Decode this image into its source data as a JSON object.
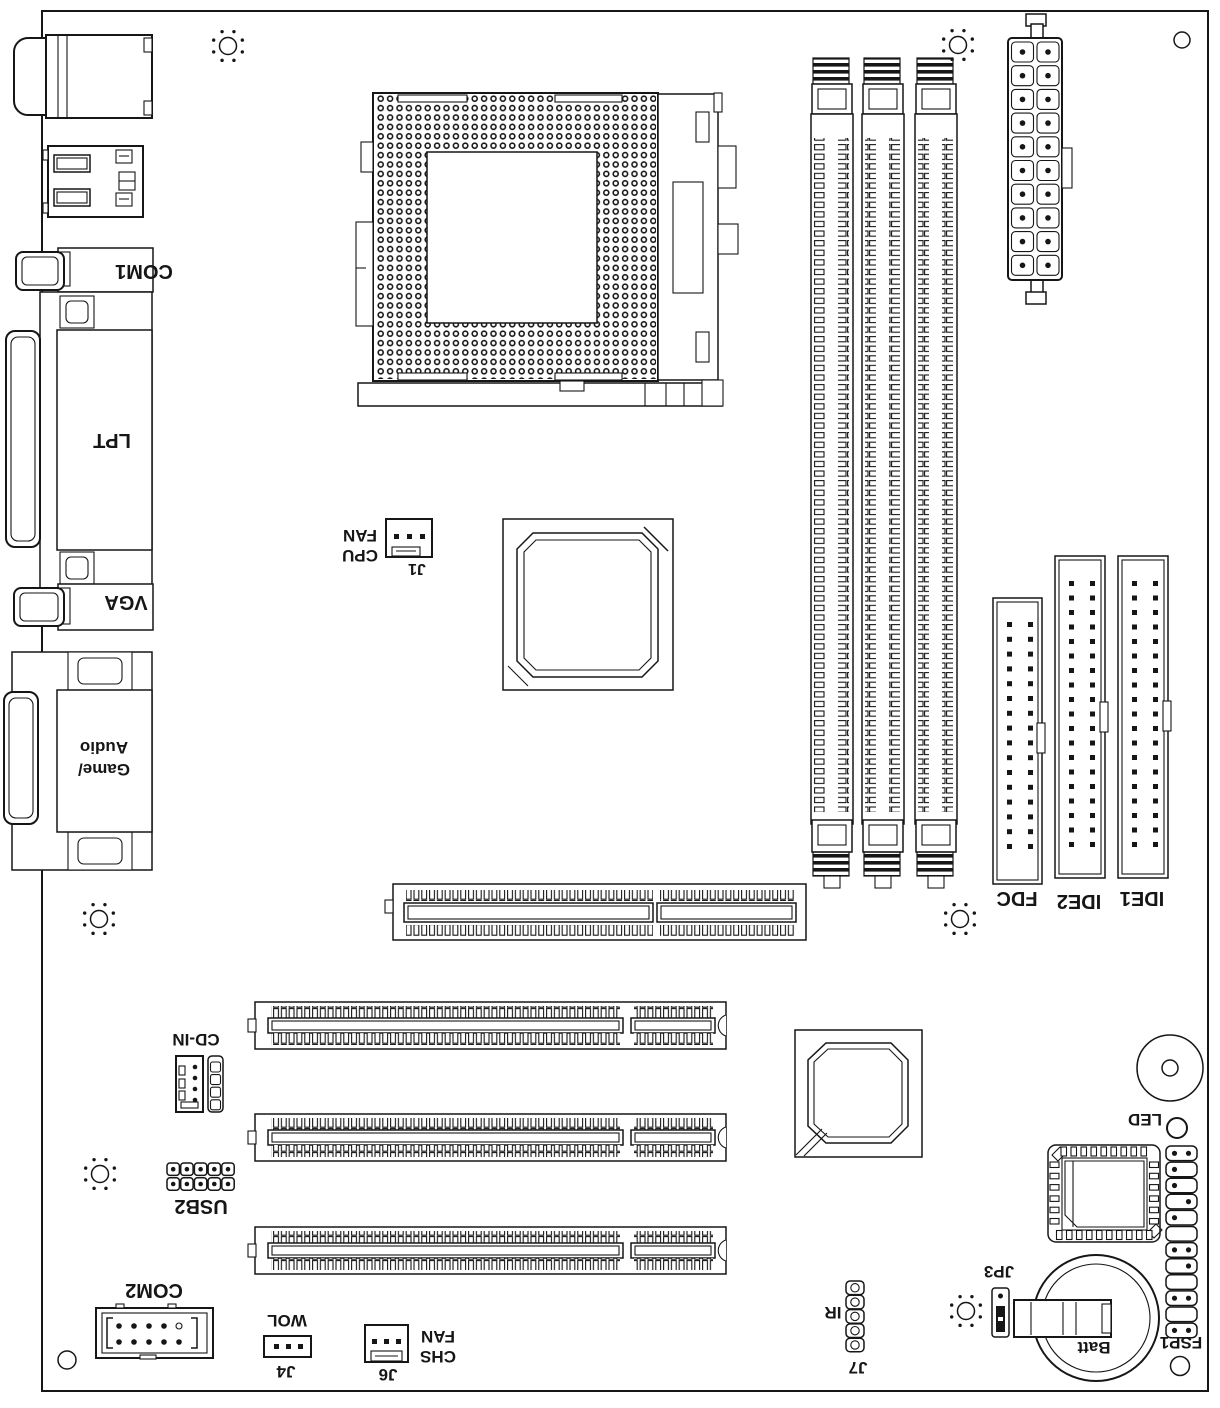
{
  "diagram": {
    "type": "motherboard-layout-diagram",
    "colors": {
      "line": "#161616",
      "background": "#ffffff"
    },
    "labels": {
      "com1": "COM1",
      "lpt": "LPT",
      "vga": "VGA",
      "game_audio_line1": "Game/",
      "game_audio_line2": "Audio",
      "cpu_fan_line1": "CPU",
      "cpu_fan_line2": "FAN",
      "j1": "J1",
      "fdc": "FDC",
      "ide2": "IDE2",
      "ide1": "IDE1",
      "cd_in": "CD-IN",
      "usb2": "USB2",
      "com2": "COM2",
      "wol": "WOL",
      "j4": "J4",
      "chs_fan_line1": "CHS",
      "chs_fan_line2": "FAN",
      "j6": "J6",
      "ir": "IR",
      "j7": "J7",
      "jp3": "JP3",
      "batt": "Batt",
      "fsp1": "FSP1",
      "led": "LED"
    }
  }
}
